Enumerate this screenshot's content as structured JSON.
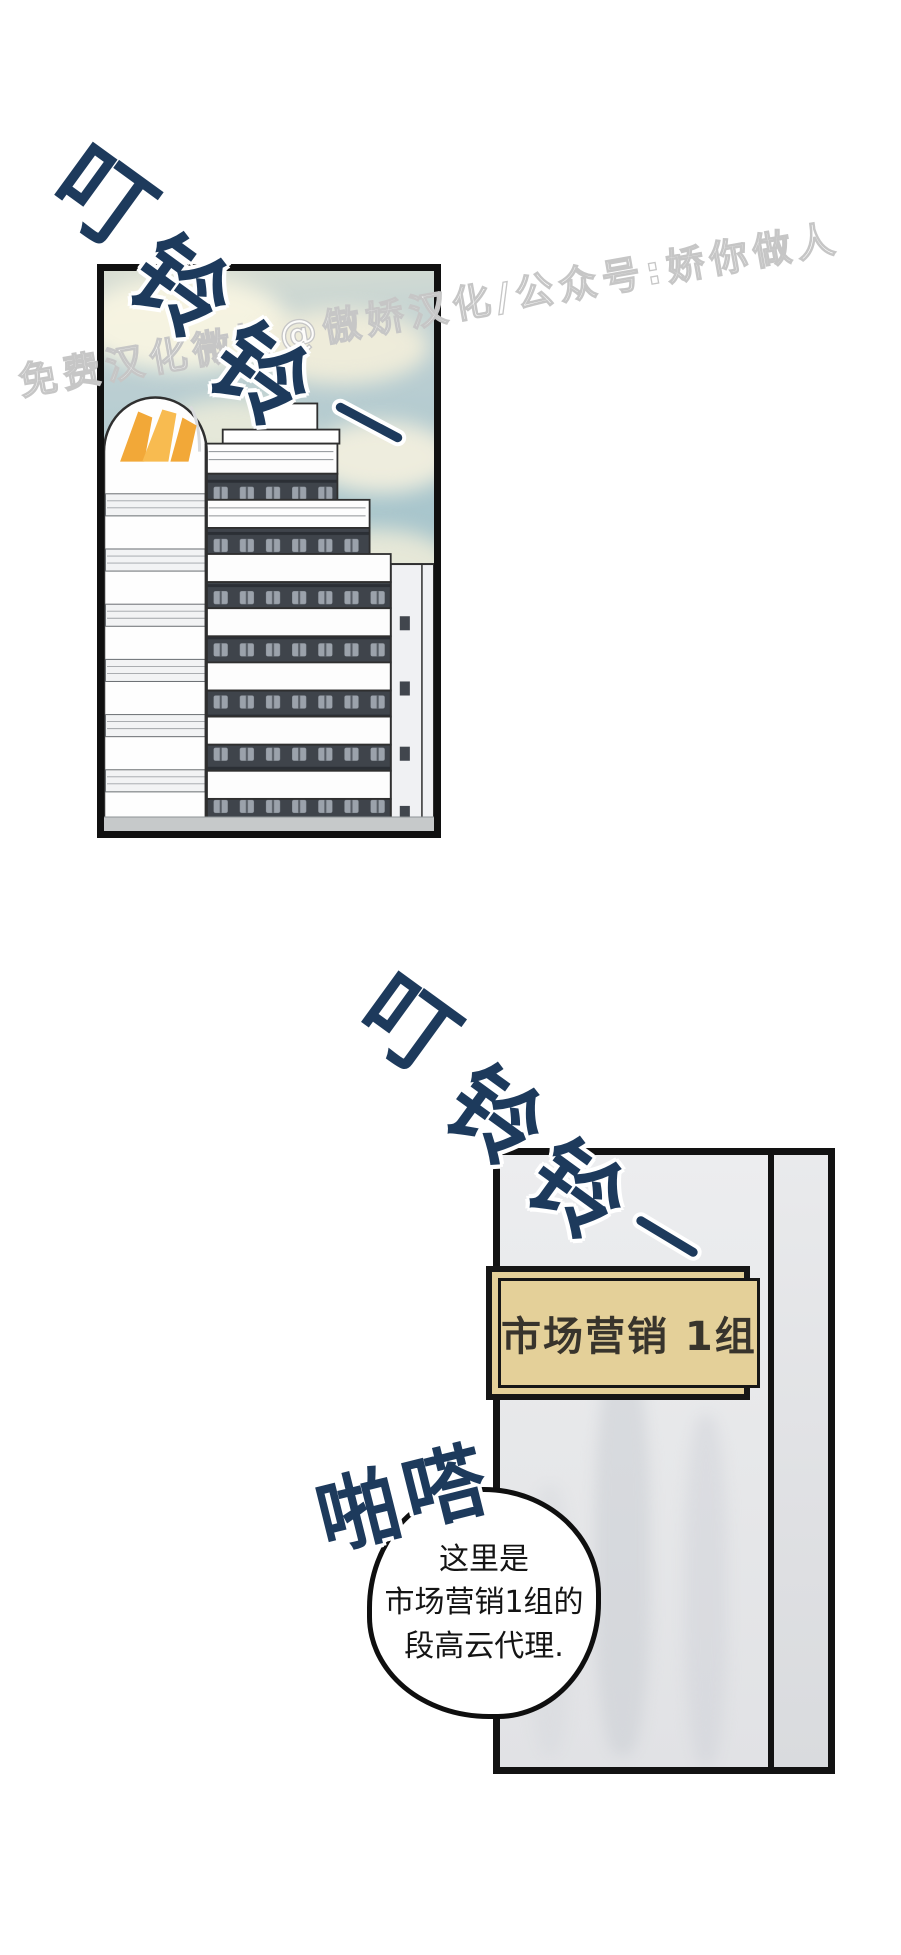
{
  "watermark": {
    "text": "免费汉化微博@傲娇汉化/公众号:娇你做人"
  },
  "sfx": {
    "ring_top": {
      "chars": [
        "叮",
        "铃",
        "铃"
      ]
    },
    "ring_mid": {
      "chars": [
        "叮",
        "铃",
        "铃"
      ]
    },
    "click": {
      "chars": [
        "啪",
        "嗒"
      ]
    }
  },
  "door": {
    "sign_text": "市场营销 1组"
  },
  "speech_bubble": {
    "lines": [
      "这里是",
      "市场营销1组的",
      "段高云代理."
    ]
  },
  "colors": {
    "sfx_navy": "#1d3a5c",
    "watermark_outline": "#c6c6c6",
    "sky_teal": "#a7c5cc",
    "cloud_cream": "#f3eeda",
    "logo_orange": "#f4ad3c",
    "sign_tan": "#e4d099",
    "door_gray": "#e9eaec",
    "balcony_band_dark": "#3f444b",
    "panel_border_black": "#101010"
  }
}
